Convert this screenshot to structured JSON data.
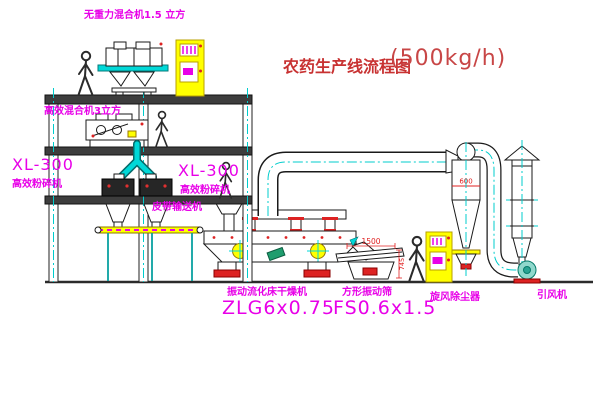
{
  "title": {
    "main": "农药生产线流程图",
    "capacity": "(500kg/h)"
  },
  "labels": {
    "mixer_3d": "无重力混合机1.5 立方",
    "mixer_high_eff": "高效混合机3立方",
    "mill_left_model": "XL-300",
    "mill_left_name": "高效粉碎机",
    "mill_right_model": "XL-300",
    "mill_right_name": "高效粉碎机",
    "belt_conveyor": "皮带输送机",
    "dryer_name": "振动流化床干燥机",
    "dryer_model": "ZLG6x0.75",
    "screen_name": "方形振动筛",
    "screen_model": "FS0.6x1.5",
    "cyclone": "旋风除尘器",
    "fan": "引风机"
  },
  "dimensions": {
    "screen_length": "1500",
    "screen_height": "745",
    "cyclone_diameter": "600"
  },
  "colors": {
    "label_magenta": "#e800e8",
    "title_red": "#c83232",
    "dimension_red": "#e02020",
    "equipment_yellow": "#ffff00",
    "pipe_cyan": "#00d8d8",
    "structure_dark": "#3d3d3d"
  }
}
